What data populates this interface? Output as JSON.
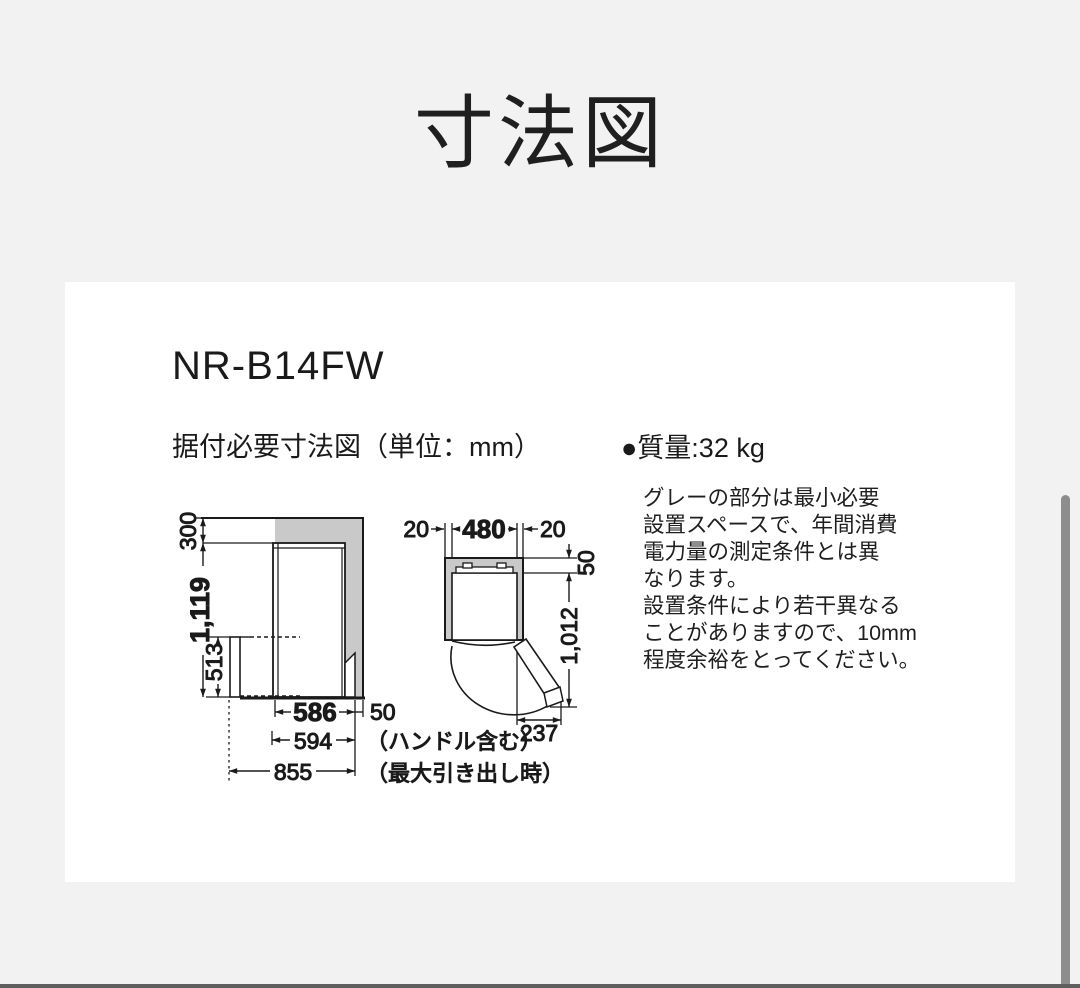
{
  "page": {
    "title": "寸法図"
  },
  "card": {
    "model": "NR-B14FW",
    "subtitle": "据付必要寸法図（単位：mm）",
    "mass": "●質量:32 kg",
    "note": "グレーの部分は最小必要\n設置スペースで、年間消費\n電力量の測定条件とは異\nなります。\n設置条件により若干異なる\nことがありますので、10mm\n程度余裕をとってください。"
  },
  "side_view": {
    "top_clearance": "300",
    "height": "1,119",
    "drawer_height": "513",
    "depth": "586",
    "rear_clearance": "50",
    "depth_with_handle": "594",
    "handle_note": "（ハンドル含む）",
    "max_pullout": "855",
    "pullout_note": "（最大引き出し時）"
  },
  "top_view": {
    "left_clearance": "20",
    "width": "480",
    "right_clearance": "20",
    "back_clearance": "50",
    "depth_door_open": "1,012",
    "door_swing": "237"
  },
  "colors": {
    "min_space_gray": "#c9c9c9",
    "line": "#1a1a1a",
    "page_bg": "#f2f2f2",
    "card_bg": "#ffffff",
    "scrollbar": "#8d8d8d"
  }
}
